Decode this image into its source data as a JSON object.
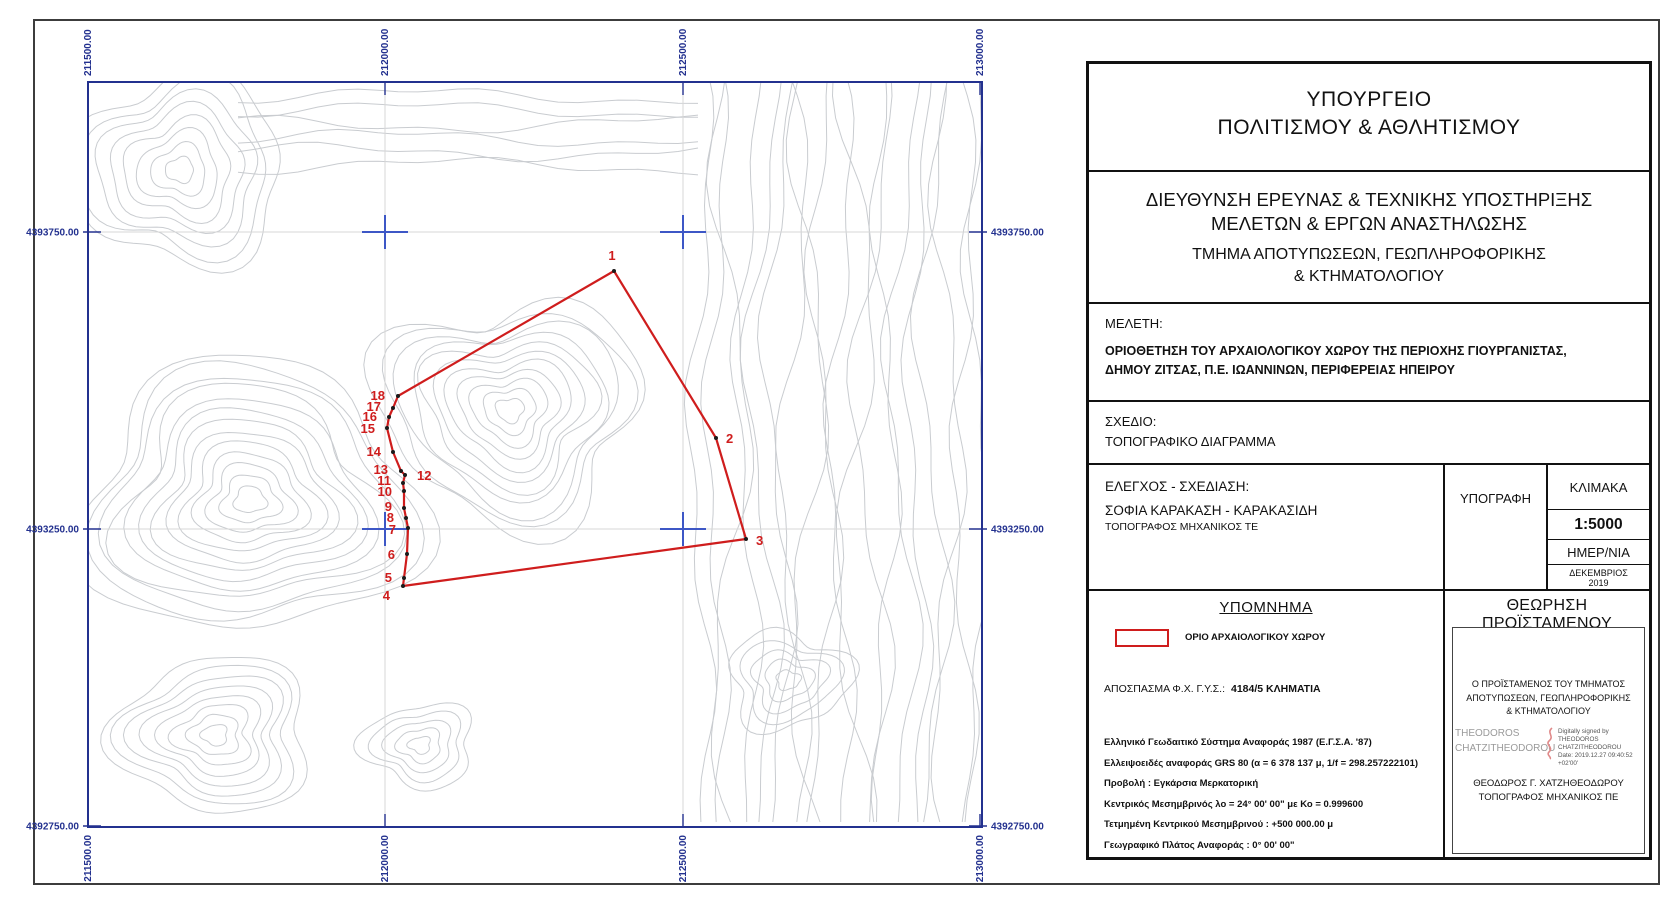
{
  "map": {
    "frame_color": "#23318f",
    "contour_color": "#c9ccd0",
    "cross_color": "#3d57c6",
    "x_ticks": [
      {
        "label": "211500.00",
        "x": 0
      },
      {
        "label": "212000.00",
        "x": 297
      },
      {
        "label": "212500.00",
        "x": 595
      },
      {
        "label": "213000.00",
        "x": 892
      }
    ],
    "y_ticks": [
      {
        "label": "4393750.00",
        "y": 150
      },
      {
        "label": "4393250.00",
        "y": 447
      },
      {
        "label": "4392750.00",
        "y": 744
      }
    ],
    "grid_crosses": [
      [
        297,
        150
      ],
      [
        595,
        150
      ],
      [
        297,
        447
      ],
      [
        595,
        447
      ]
    ],
    "boundary": {
      "name": "ΟΡΙΟ ΑΡΧΑΙΟΛΟΓΙΚΟΥ ΧΩΡΟΥ",
      "color": "#cf1d1d",
      "vertices": [
        {
          "n": "1",
          "x": 526,
          "y": 189,
          "lx": 524,
          "ly": 178,
          "anchor": "middle"
        },
        {
          "n": "2",
          "x": 628,
          "y": 356,
          "lx": 638,
          "ly": 361,
          "anchor": "start"
        },
        {
          "n": "3",
          "x": 658,
          "y": 457,
          "lx": 668,
          "ly": 463,
          "anchor": "start"
        },
        {
          "n": "4",
          "x": 315,
          "y": 504,
          "lx": 302,
          "ly": 518,
          "anchor": "end"
        },
        {
          "n": "5",
          "x": 316,
          "y": 496,
          "lx": 304,
          "ly": 500,
          "anchor": "end"
        },
        {
          "n": "6",
          "x": 319,
          "y": 472,
          "lx": 307,
          "ly": 477,
          "anchor": "end"
        },
        {
          "n": "7",
          "x": 320,
          "y": 446,
          "lx": 308,
          "ly": 452,
          "anchor": "end"
        },
        {
          "n": "8",
          "x": 318,
          "y": 436,
          "lx": 306,
          "ly": 440,
          "anchor": "end"
        },
        {
          "n": "9",
          "x": 316,
          "y": 426,
          "lx": 304,
          "ly": 429,
          "anchor": "end"
        },
        {
          "n": "10",
          "x": 316,
          "y": 409,
          "lx": 304,
          "ly": 414,
          "anchor": "end"
        },
        {
          "n": "11",
          "x": 315,
          "y": 401,
          "lx": 303,
          "ly": 403,
          "anchor": "end"
        },
        {
          "n": "12",
          "x": 317,
          "y": 393,
          "lx": 329,
          "ly": 398,
          "anchor": "start"
        },
        {
          "n": "13",
          "x": 313,
          "y": 389,
          "lx": 300,
          "ly": 392,
          "anchor": "end"
        },
        {
          "n": "14",
          "x": 305,
          "y": 370,
          "lx": 293,
          "ly": 374,
          "anchor": "end"
        },
        {
          "n": "15",
          "x": 299,
          "y": 346,
          "lx": 287,
          "ly": 351,
          "anchor": "end"
        },
        {
          "n": "16",
          "x": 301,
          "y": 335,
          "lx": 289,
          "ly": 339,
          "anchor": "end"
        },
        {
          "n": "17",
          "x": 305,
          "y": 326,
          "lx": 293,
          "ly": 329,
          "anchor": "end"
        },
        {
          "n": "18",
          "x": 310,
          "y": 314,
          "lx": 297,
          "ly": 318,
          "anchor": "end"
        }
      ]
    }
  },
  "title_block": {
    "ministry_line1": "ΥΠΟΥΡΓΕΙΟ",
    "ministry_line2": "ΠΟΛΙΤΙΣΜΟΥ & ΑΘΛΗΤΙΣΜΟΥ",
    "directorate_line1": "ΔΙΕΥΘΥΝΣΗ ΕΡΕΥΝΑΣ & ΤΕΧΝΙΚΗΣ ΥΠΟΣΤΗΡΙΞΗΣ",
    "directorate_line2": "ΜΕΛΕΤΩΝ & ΕΡΓΩΝ ΑΝΑΣΤΗΛΩΣΗΣ",
    "department_line1": "ΤΜΗΜΑ ΑΠΟΤΥΠΩΣΕΩΝ, ΓΕΩΠΛΗΡΟΦΟΡΙΚΗΣ",
    "department_line2": "& ΚΤΗΜΑΤΟΛΟΓΙΟΥ",
    "study_label": "ΜΕΛΕΤΗ:",
    "study_line1": "ΟΡΙΟΘΕΤΗΣΗ ΤΟΥ ΑΡΧΑΙΟΛΟΓΙΚΟΥ ΧΩΡΟΥ ΤΗΣ ΠΕΡΙΟΧΗΣ ΓΙΟΥΡΓΑΝΙΣΤΑΣ,",
    "study_line2": "ΔΗΜΟΥ ΖΙΤΣΑΣ, Π.Ε. ΙΩΑΝΝΙΝΩΝ, ΠΕΡΙΦΕΡΕΙΑΣ ΗΠΕΙΡΟΥ",
    "drawing_label": "ΣΧΕΔΙΟ:",
    "drawing_value": "ΤΟΠΟΓΡΑΦΙΚΟ ΔΙΑΓΡΑΜΜΑ",
    "check_label": "ΕΛΕΓΧΟΣ - ΣΧΕΔΙΑΣΗ:",
    "check_name": "ΣΟΦΙΑ ΚΑΡΑΚΑΣΗ - ΚΑΡΑΚΑΣΙΔΗ",
    "check_title": "ΤΟΠΟΓΡΑΦΟΣ ΜΗΧΑΝΙΚΟΣ ΤΕ",
    "signature_label": "ΥΠΟΓΡΑΦΗ",
    "scale_label": "ΚΛΙΜΑΚΑ",
    "scale_value": "1:5000",
    "date_label": "ΗΜΕΡ/ΝΙΑ",
    "date_value_line1": "ΔΕΚΕΜΒΡΙΟΣ",
    "date_value_line2": "2019",
    "legend_title": "ΥΠΟΜΝΗΜΑ",
    "legend_item1": "ΟΡΙΟ ΑΡΧΑΙΟΛΟΓΙΚΟΥ ΧΩΡΟΥ",
    "excerpt_label": "ΑΠΟΣΠΑΣΜΑ Φ.Χ. Γ.Υ.Σ.:",
    "excerpt_value": "4184/5 ΚΛΗΜΑΤΙΑ",
    "geodetic_notes": [
      "Ελληνικό Γεωδαιτικό Σύστημα Αναφοράς 1987 (Ε.Γ.Σ.Α. '87)",
      "Ελλειψοειδές αναφοράς GRS 80 (α = 6 378 137 μ, 1/f = 298.257222101)",
      "Προβολή : Εγκάρσια Μερκατορική",
      "Κεντρικός Μεσημβρινός λο = 24° 00' 00\" με Κο = 0.999600",
      "Τετμημένη Κεντρικού Μεσημβρινού : +500 000.00 μ",
      "Γεωγραφικό Πλάτος Αναφοράς : 0° 00' 00\""
    ],
    "approval": {
      "title": "ΘΕΩΡΗΣΗ ΠΡΟΪΣΤΑΜΕΝΟΥ",
      "head_line1": "Ο ΠΡΟΪΣΤΑΜΕΝΟΣ ΤΟΥ ΤΜΗΜΑΤΟΣ",
      "head_line2": "ΑΠΟΤΥΠΩΣΕΩΝ, ΓΕΩΠΛΗΡΟΦΟΡΙΚΗΣ",
      "head_line3": "& ΚΤΗΜΑΤΟΛΟΓΙΟΥ",
      "digital_name_line1": "THEODOROS",
      "digital_name_line2": "CHATZITHEODOROU",
      "digital_details_line1": "Digitally signed by THEODOROS",
      "digital_details_line2": "CHATZITHEODOROU",
      "digital_details_line3": "Date: 2019.12.27 09:40:52",
      "digital_details_line4": "+02'00'",
      "signer_name": "ΘΕΟΔΩΡΟΣ Γ. ΧΑΤΖΗΘΕΟΔΩΡΟΥ",
      "signer_title": "ΤΟΠΟΓΡΑΦΟΣ ΜΗΧΑΝΙΚΟΣ ΠΕ"
    }
  }
}
